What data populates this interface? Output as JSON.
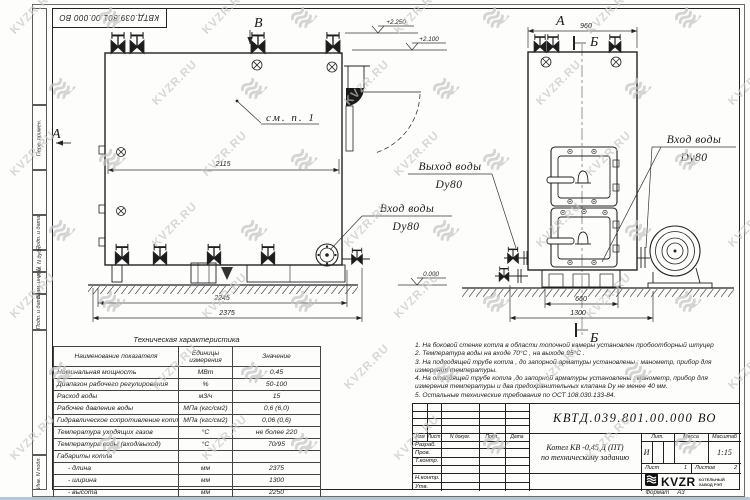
{
  "watermark": {
    "text": "KVZR.RU"
  },
  "corner_stamp": {
    "designation": "КВТД.039.801.00.000 ВО"
  },
  "margins": [
    "Перв. примен.",
    "Подп. и дата",
    "Инв. N дубл.",
    "Взам. инв. N",
    "Подп. и дата",
    "Инв. N подл."
  ],
  "drawing": {
    "view_side_label": "В",
    "view_front_label": "А",
    "section_label": "Б",
    "see_note": "см. п. 1",
    "elevation_top": "+2.250",
    "elevation_mid": "+2.100",
    "elevation_zero": "0.000",
    "dim_width_inner": "2115",
    "dim_base": "2245",
    "dim_length": "2375",
    "dim_front_top": "960",
    "dim_front_base": "660",
    "dim_front_full": "1300",
    "outlet_label": "Выход воды",
    "outlet_dn": "Dy80",
    "inlet_label": "Вход воды",
    "inlet_dn": "Dy80",
    "inlet_right_label": "Вход воды",
    "inlet_right_dn": "Dy80"
  },
  "spec_table": {
    "title": "Техническая характеристика",
    "headers": [
      "Наименование показателя",
      "Единицы измерения",
      "Значение"
    ],
    "rows": [
      [
        "Номинальная мощность",
        "МВт",
        "0,45"
      ],
      [
        "Диапазон рабочего регулирования",
        "%",
        "50-100"
      ],
      [
        "Расход воды",
        "м3/ч",
        "15"
      ],
      [
        "Рабочее давление воды",
        "МПа (кгс/см2)",
        "0,6 (6,0)"
      ],
      [
        "Гидравлическое сопротивление котла",
        "МПа (кгс/см2)",
        "0,06 (0,6)"
      ],
      [
        "Температура уходящих газов",
        "°С",
        "не более 220"
      ],
      [
        "Температура воды (вход/выход)",
        "°С",
        "70/95"
      ],
      [
        "Габариты котла",
        "",
        ""
      ],
      [
        "- длина",
        "мм",
        "2375"
      ],
      [
        "- ширина",
        "мм",
        "1300"
      ],
      [
        "- высота",
        "мм",
        "2250"
      ]
    ]
  },
  "notes": {
    "lines": [
      "1.  На боковой стенке котла в области топочной камеры установлен пробоотборный штуцер",
      "2.  Температура воды на входе  70°С ,  на выходе  95°С .",
      "3.  На подводящей трубе котла , до запорной арматуры установлены :  манометр, прибор для",
      "измерения температуры.",
      "4.  На отводящей трубе котла ,до запорной арматуры установлены :  манометр, прибор для",
      "измерения температуры и два предохранительных клапана  Dу не менее  40 мм.",
      "5.  Остальные технические требования по ОСТ  108.030.133-84."
    ]
  },
  "title_block": {
    "designation": "КВТД.039.801.00.000  ВО",
    "product_line1": "Котел  КВ -0,45  Д  (ПТ)",
    "product_line2": "по техническому заданию",
    "col_headers": [
      "Изм",
      "Лист",
      "N докум.",
      "Подп.",
      "Дата"
    ],
    "sig_rows": [
      "Разраб.",
      "Пров.",
      "Т.контр.",
      "",
      "Н.контр.",
      "Утв."
    ],
    "lit_header": "Лит.",
    "mass_header": "Масса",
    "scale_header": "Масштаб",
    "lit_value": "И",
    "scale_value": "1:15",
    "sheet_label": "Лист",
    "sheet_value": "1",
    "sheets_label": "Листов",
    "sheets_value": "2",
    "logo": {
      "text": "KVZR",
      "sub1": "КОТЕЛЬНЫЙ",
      "sub2": "ЗАВОД РЭП"
    },
    "format_label": "Формат",
    "format_value": "А3"
  }
}
